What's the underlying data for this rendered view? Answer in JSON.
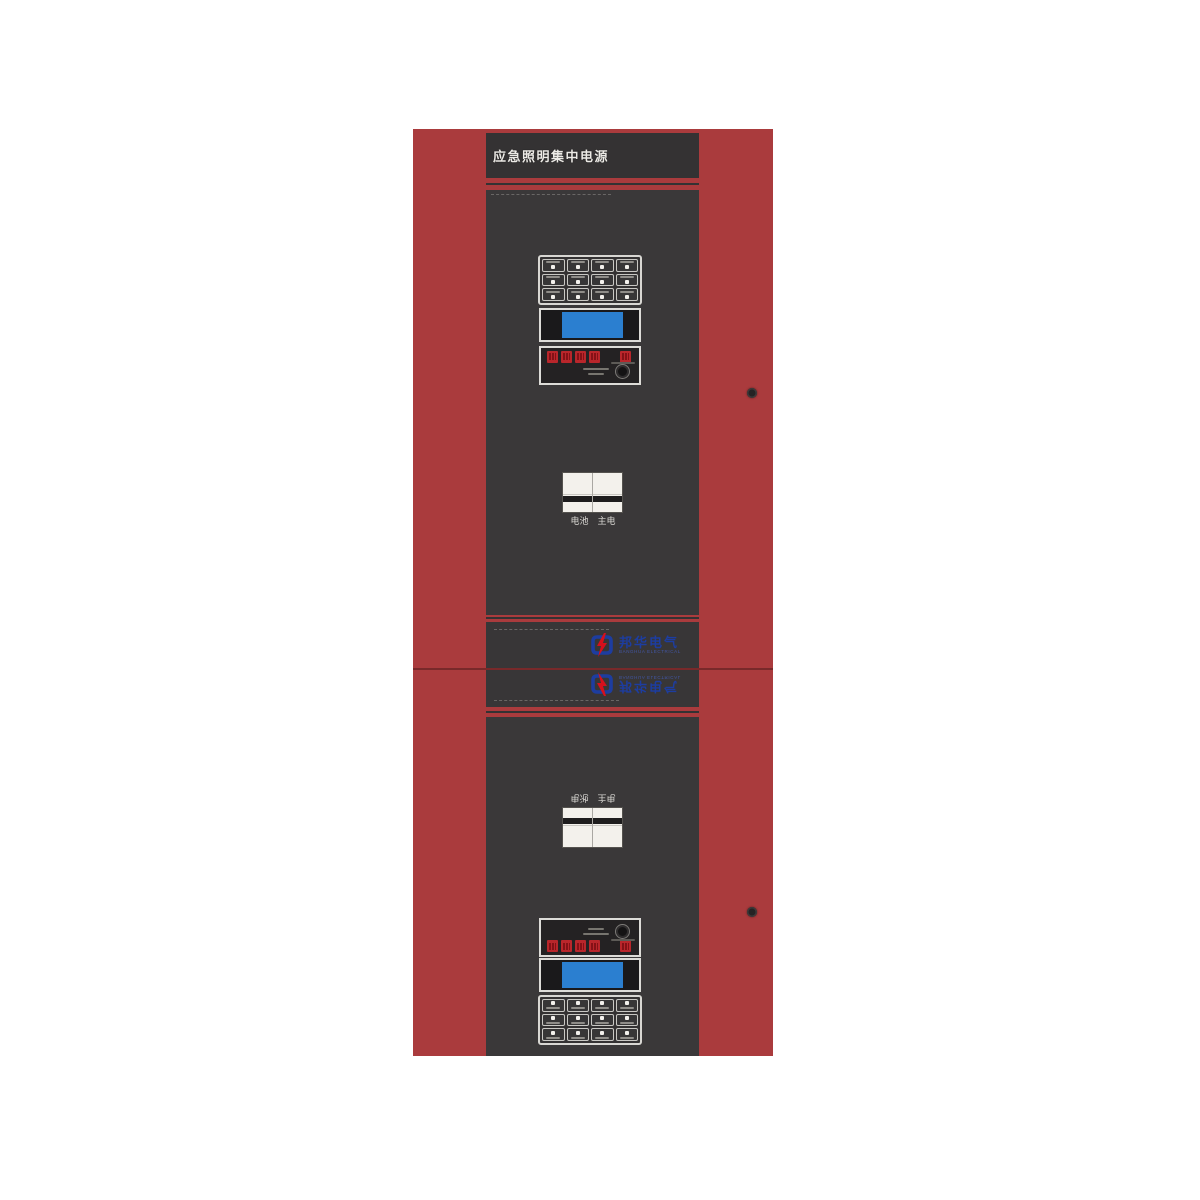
{
  "page": {
    "background_color": "#ffffff"
  },
  "cabinet": {
    "header_title": "应急照明集中电源",
    "colors": {
      "frame_red": "#aa3b3d",
      "panel_dark": "#3a3839",
      "header_bar": "#343233",
      "lcd_screen_blue": "#2b7fd0",
      "led_red": "#b9262b",
      "breaker_white": "#f3f1ec",
      "logo_blue": "#1d3da0",
      "logo_red": "#d5101c"
    },
    "screw_count": 2
  },
  "branding": {
    "logo_text_cn": "邦华电气",
    "logo_text_en": "BANGHUA ELECTRICAL"
  },
  "keypad": {
    "rows": 3,
    "cols": 4,
    "button_count": 12,
    "micro_labels": "illegible"
  },
  "indicator_panel": {
    "leds_left": 4,
    "leds_right": 1,
    "has_knob": true,
    "micro_text": "illegible"
  },
  "lcd": {
    "screen_color": "#2b7fd0"
  },
  "units": {
    "upper": {
      "breaker_label_left": "电池",
      "breaker_label_right": "主电"
    },
    "lower": {
      "breaker_label_left": "电池",
      "breaker_label_right": "主电",
      "mirrored": true
    }
  }
}
